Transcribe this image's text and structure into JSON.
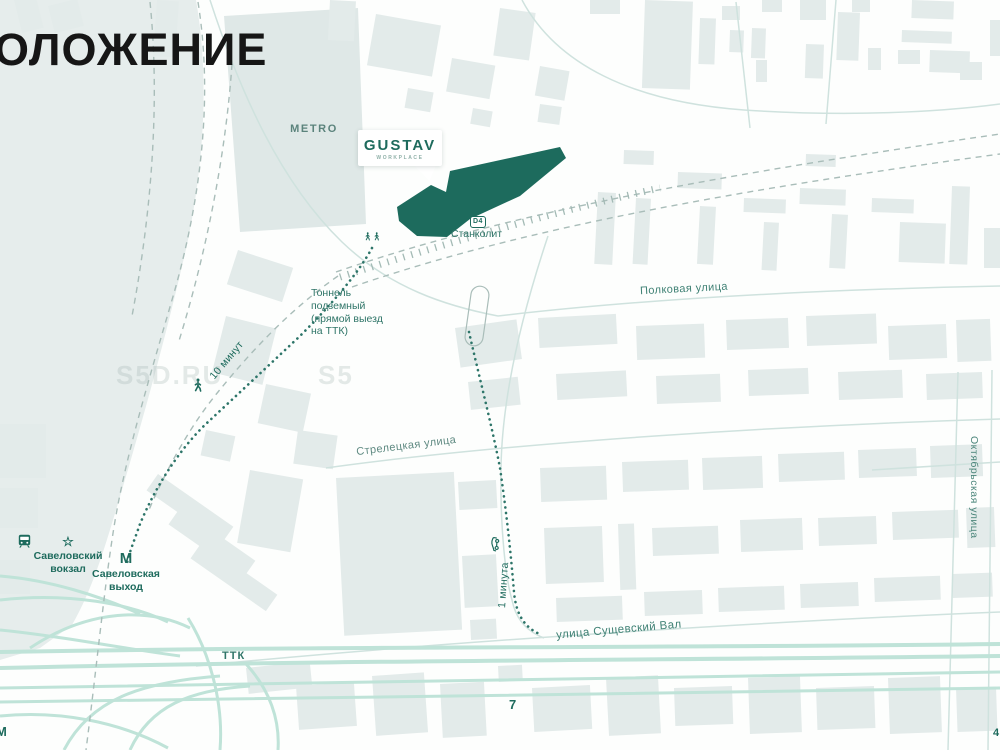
{
  "page": {
    "title": "ОЛОЖЕНИЕ"
  },
  "colors": {
    "accent_teal": "#1d6b5d",
    "poi_label": "#2f7568",
    "street_label": "#3f8174",
    "building_fill": "#e3ebea",
    "road_line": "#cfe2de",
    "highway_mint": "#bfe3d8",
    "railway_dash": "#a9bdb9",
    "title_color": "#161616"
  },
  "watermark": {
    "text": "S5D.RU",
    "partial": "S5"
  },
  "callout": {
    "title": "GUSTAV",
    "subtitle": "WORKPLACE"
  },
  "poi": {
    "metro_territory": "METRO",
    "station_badge": "D4",
    "station_name": "Станколит",
    "tunnel_note": "Тоннель\nподземный\n(прямой выезд\nна ТТК)",
    "walk_time": "10 минут",
    "drive_time": "1 минута",
    "rail_terminal": "Савеловский\nвокзал",
    "metro_letter": "М",
    "metro_exit": "Савеловская\nвыход",
    "map_number": "7",
    "corner_metro_letter": "М",
    "edge_label": "4"
  },
  "streets": {
    "polkovaya": "Полковая улица",
    "streletskaya": "Стрелецкая улица",
    "sushchevsky": "улица Сущевский Вал",
    "oktyabrskaya": "Октябрьская улица",
    "ttk": "ТТК"
  }
}
